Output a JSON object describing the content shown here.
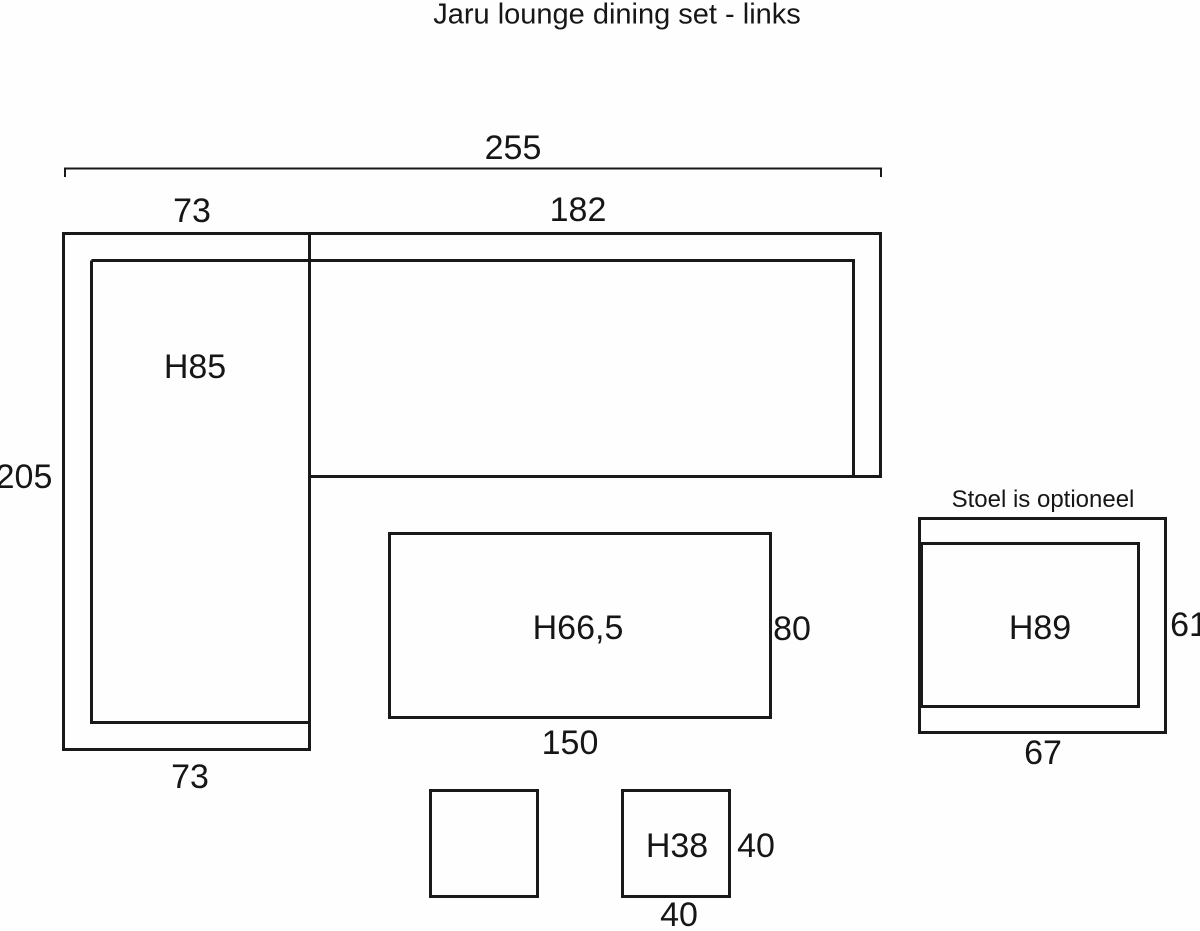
{
  "page": {
    "title": "Jaru lounge dining set - links",
    "line_color": "#191919",
    "text_color": "#161616",
    "background": "#fefefe"
  },
  "sofa": {
    "overall_width": "255",
    "left_section_width": "73",
    "right_section_width": "182",
    "height_label": "H85",
    "total_depth": "205",
    "left_section_bottom_width": "73"
  },
  "table": {
    "height_label": "H66,5",
    "depth": "80",
    "width": "150"
  },
  "chair": {
    "note": "Stoel is optioneel",
    "height_label": "H89",
    "depth": "61",
    "width": "67"
  },
  "stool": {
    "height_label": "H38",
    "depth": "40",
    "width": "40"
  }
}
